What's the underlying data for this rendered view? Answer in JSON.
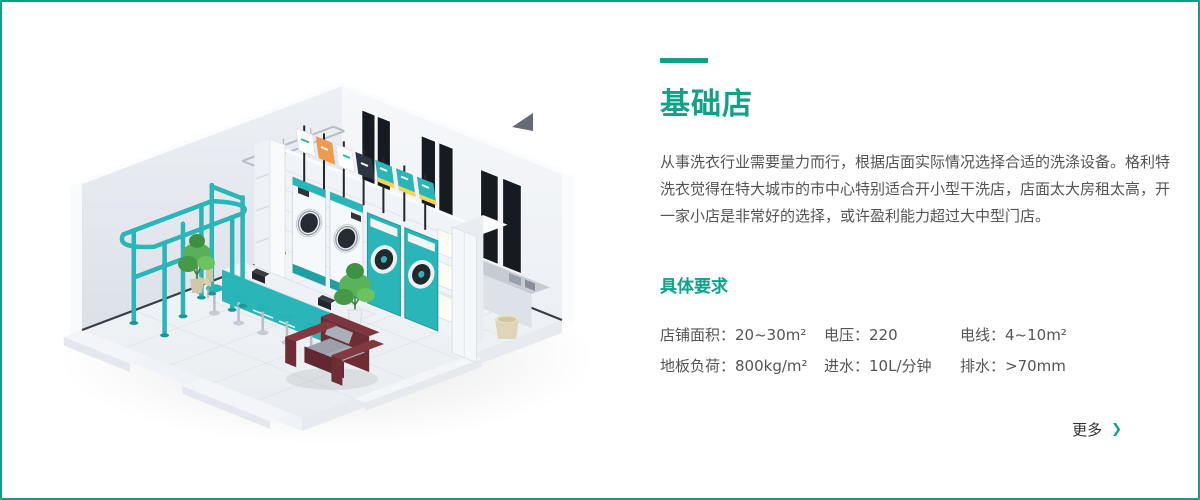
{
  "section": {
    "title": "基础店",
    "description": "从事洗衣行业需要量力而行，根据店面实际情况选择合适的洗涤设备。格利特洗衣觉得在特大城市的市中心特别适合开小型干洗店，店面太大房租太高，开一家小店是非常好的选择，或许盈利能力超过大中型门店。",
    "requirements": {
      "heading": "具体要求",
      "items": [
        "店铺面积：20~30m²",
        "电压：220",
        "电线：4~10m²",
        "地板负荷：800kg/m²",
        "进水：10L/分钟",
        "排水：>70mm"
      ]
    },
    "more_link": {
      "label": "更多",
      "icon": "chevron-right",
      "glyph": "❯"
    }
  },
  "colors": {
    "accent": "#0fa287",
    "border": "#0aa287",
    "body-text": "#555555",
    "link-text": "#333333",
    "illustration-teal": "#2ab5b8"
  }
}
